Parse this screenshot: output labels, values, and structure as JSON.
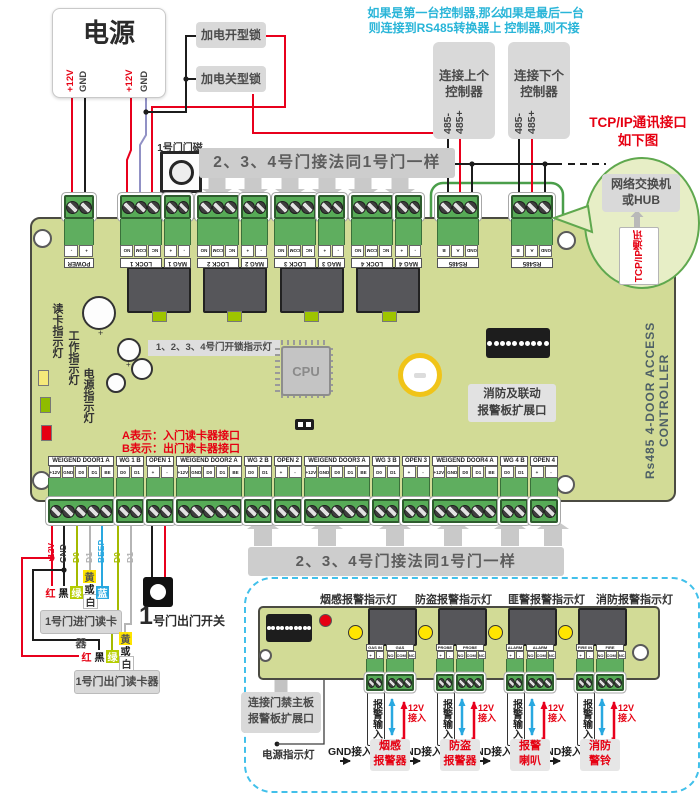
{
  "palette": {
    "board_green": "#d2db96",
    "terminal_green": "#57ab57",
    "accent_red": "#e60012",
    "cyan_note": "#29b5d8",
    "wire_red": "#e8001c",
    "wire_black": "#1c1c1c",
    "wire_purple": "#9191c5",
    "wire_green": "#a4ba00",
    "wire_gray": "#b5b5b5",
    "wire_blue": "#29a8e0",
    "led_yellow": "#ffe500",
    "led_green": "#9ec400",
    "gray_box": "#d9d9d9"
  },
  "power": {
    "title": "电源",
    "pins": [
      "+12V",
      "GND",
      "+12V",
      "GND"
    ]
  },
  "locks": {
    "open": "加电开型锁",
    "close": "加电关型锁"
  },
  "door_magnet": {
    "label": "1号门门磁"
  },
  "banners": {
    "top": "2、3、4号门接法同1号门一样",
    "bottom": "2、3、4号门接法同1号门一样"
  },
  "notes": {
    "first_controller": "如果是第一台控制器,那么\n则连接到RS485转换器上",
    "last_controller": "如果是最后一台\n控制器,则不接",
    "reader_a": "A表示：入门读卡器接口",
    "reader_b": "B表示：出门读卡器接口"
  },
  "connectors": {
    "prev": {
      "label": "连接上个\n控制器",
      "pins": [
        "485-",
        "485+"
      ]
    },
    "next": {
      "label": "连接下个\n控制器",
      "pins": [
        "485-",
        "485+"
      ]
    }
  },
  "tcpip": {
    "headline": "TCP/IP通讯接口\n如下图",
    "hub": "网络交换机\n或HUB",
    "port": "TCP/IP通讯"
  },
  "board": {
    "side_label": "Rs485 4-DOOR ACCESS CONTROLLER",
    "cpu": "CPU",
    "indicators": [
      "读卡指示灯",
      "工作指示灯",
      "电源指示灯"
    ],
    "unlock_label": "1、2、3、4号门开锁指示灯",
    "fire_expansion": "消防及联动\n报警板扩展口",
    "top_terminals": [
      {
        "name": "POWER",
        "pins": [
          "+",
          "-"
        ]
      },
      {
        "name": "LOCK 1",
        "pins": [
          "NC",
          "COM",
          "NO"
        ]
      },
      {
        "name": "MAG 1",
        "pins": [
          "-",
          "+"
        ]
      },
      {
        "name": "LOCK 2",
        "pins": [
          "NC",
          "COM",
          "NO"
        ]
      },
      {
        "name": "MAG 2",
        "pins": [
          "-",
          "+"
        ]
      },
      {
        "name": "LOCK 3",
        "pins": [
          "NC",
          "COM",
          "NO"
        ]
      },
      {
        "name": "MAG 3",
        "pins": [
          "-",
          "+"
        ]
      },
      {
        "name": "LOCK 4",
        "pins": [
          "NC",
          "COM",
          "NO"
        ]
      },
      {
        "name": "MAG 4",
        "pins": [
          "-",
          "+"
        ]
      },
      {
        "name": "RS485",
        "pins": [
          "GND",
          "A",
          "B"
        ]
      },
      {
        "name": "RS485",
        "pins": [
          "GND",
          "A",
          "B"
        ]
      }
    ],
    "bottom_terminals": [
      {
        "name": "WEIGEND DOOR1  A",
        "pins": [
          "+12V",
          "GND",
          "D0",
          "D1",
          "BE"
        ]
      },
      {
        "name": "WG 1 B",
        "pins": [
          "D0",
          "D1"
        ]
      },
      {
        "name": "OPEN 1",
        "pins": [
          "+",
          "-"
        ]
      },
      {
        "name": "WEIGEND DOOR2  A",
        "pins": [
          "+12V",
          "GND",
          "D0",
          "D1",
          "BE"
        ]
      },
      {
        "name": "WG 2 B",
        "pins": [
          "D0",
          "D1"
        ]
      },
      {
        "name": "OPEN 2",
        "pins": [
          "+",
          "-"
        ]
      },
      {
        "name": "WEIGEND DOOR3  A",
        "pins": [
          "+12V",
          "GND",
          "D0",
          "D1",
          "BE"
        ]
      },
      {
        "name": "WG 3 B",
        "pins": [
          "D0",
          "D1"
        ]
      },
      {
        "name": "OPEN 3",
        "pins": [
          "+",
          "-"
        ]
      },
      {
        "name": "WEIGEND DOOR4  A",
        "pins": [
          "+12V",
          "GND",
          "D0",
          "D1",
          "BE"
        ]
      },
      {
        "name": "WG 4 B",
        "pins": [
          "D0",
          "D1"
        ]
      },
      {
        "name": "OPEN 4",
        "pins": [
          "+",
          "-"
        ]
      }
    ]
  },
  "readers": {
    "wire_tags": [
      "+12V",
      "GND",
      "D0",
      "D1",
      "BEEP",
      "D0",
      "D1"
    ],
    "entry": {
      "label": "1号门进门读卡器",
      "chips": [
        "红",
        "黑",
        "绿"
      ],
      "chip_stack": [
        "黄",
        "或",
        "白"
      ],
      "chip_last": "蓝"
    },
    "exit": {
      "label": "1号门出门读卡器",
      "chips": [
        "红",
        "黑",
        "绿"
      ],
      "chip_stack": [
        "黄",
        "或",
        "白"
      ]
    }
  },
  "exit_switch": {
    "number": "1",
    "label": "号门出门开关"
  },
  "alarm": {
    "indicator_labels": [
      "烟感报警指示灯",
      "防盗报警指示灯",
      "匪警报警指示灯",
      "消防报警指示灯"
    ],
    "input_label": "报警输入",
    "v12": "12V\n接入",
    "v12_plus": "+",
    "gnd": "GND接入",
    "devices": [
      "烟感\n报警器",
      "防盗\n报警器",
      "报警\n喇叭",
      "消防\n警铃"
    ],
    "link_label": "连接门禁主板\n报警板扩展口",
    "power_led_label": "电源指示灯",
    "terminal_groups": [
      {
        "in_name": "GAS IN",
        "in_pins": [
          "+",
          "-"
        ],
        "out_name": "GAS OUTPUT",
        "out_pins": [
          "NO",
          "COM",
          "NC"
        ]
      },
      {
        "in_name": "PROBE IN",
        "in_pins": [
          "+",
          "-"
        ],
        "out_name": "PROBE OUTPUT",
        "out_pins": [
          "NO",
          "COM",
          "NC"
        ]
      },
      {
        "in_name": "ALARM IN",
        "in_pins": [
          "+",
          "-"
        ],
        "out_name": "ALARM OUTPUT",
        "out_pins": [
          "NO",
          "COM",
          "NC"
        ]
      },
      {
        "in_name": "FIRE IN",
        "in_pins": [
          "+",
          "-"
        ],
        "out_name": "FIRE OUTPUT",
        "out_pins": [
          "NO",
          "COM",
          "NC"
        ]
      }
    ]
  }
}
